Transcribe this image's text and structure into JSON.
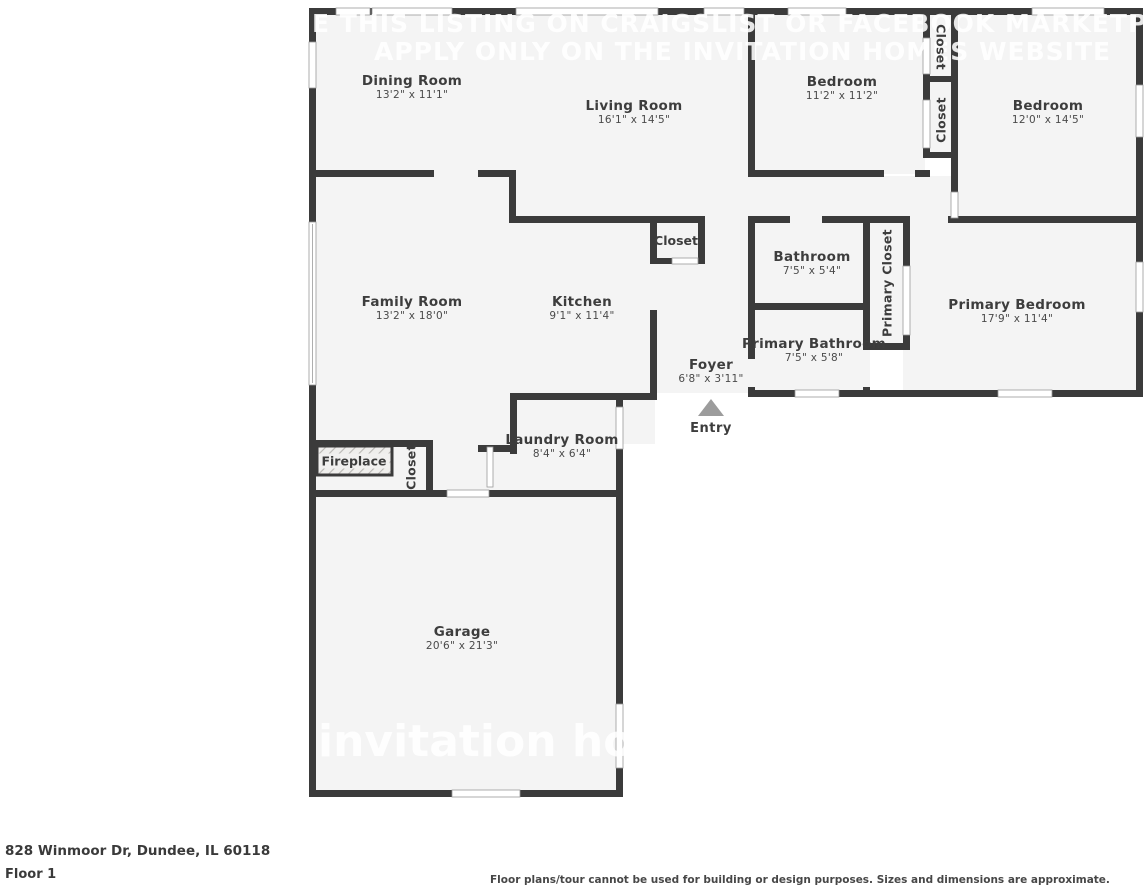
{
  "watermark": {
    "line1": "E THIS LISTING ON CRAIGSLIST OR FACEBOOK MARKETPLACE, IT IS",
    "line2": "APPLY ONLY ON THE INVITATION HOMES WEBSITE",
    "logo": "invitation hom"
  },
  "rooms": {
    "dining": {
      "name": "Dining Room",
      "dims": "13'2\" x 11'1\""
    },
    "living": {
      "name": "Living Room",
      "dims": "16'1\" x 14'5\""
    },
    "bedroom1": {
      "name": "Bedroom",
      "dims": "11'2\" x 11'2\""
    },
    "bedroom2": {
      "name": "Bedroom",
      "dims": "12'0\" x 14'5\""
    },
    "family": {
      "name": "Family Room",
      "dims": "13'2\" x 18'0\""
    },
    "kitchen": {
      "name": "Kitchen",
      "dims": "9'1\" x 11'4\""
    },
    "bathroom": {
      "name": "Bathroom",
      "dims": "7'5\" x 5'4\""
    },
    "primary_bathroom": {
      "name": "Primary Bathroom",
      "dims": "7'5\" x 5'8\""
    },
    "primary_bedroom": {
      "name": "Primary Bedroom",
      "dims": "17'9\" x 11'4\""
    },
    "foyer": {
      "name": "Foyer",
      "dims": "6'8\" x 3'11\""
    },
    "laundry": {
      "name": "Laundry Room",
      "dims": "8'4\" x 6'4\""
    },
    "garage": {
      "name": "Garage",
      "dims": "20'6\" x 21'3\""
    }
  },
  "labels": {
    "closet": "Closet",
    "primary_closet": "Primary Closet",
    "fireplace": "Fireplace",
    "entry": "Entry"
  },
  "footer": {
    "address": "828 Winmoor Dr, Dundee, IL 60118",
    "floor": "Floor 1",
    "disclaimer": "Floor plans/tour cannot be used for building or design purposes. Sizes and dimensions are approximate."
  },
  "colors": {
    "wall": "#3b3b3b",
    "floor": "#f4f4f4",
    "watermark": "#ffffff",
    "entry_arrow": "#9c9c9c",
    "label_text": "#3d3d3d"
  }
}
